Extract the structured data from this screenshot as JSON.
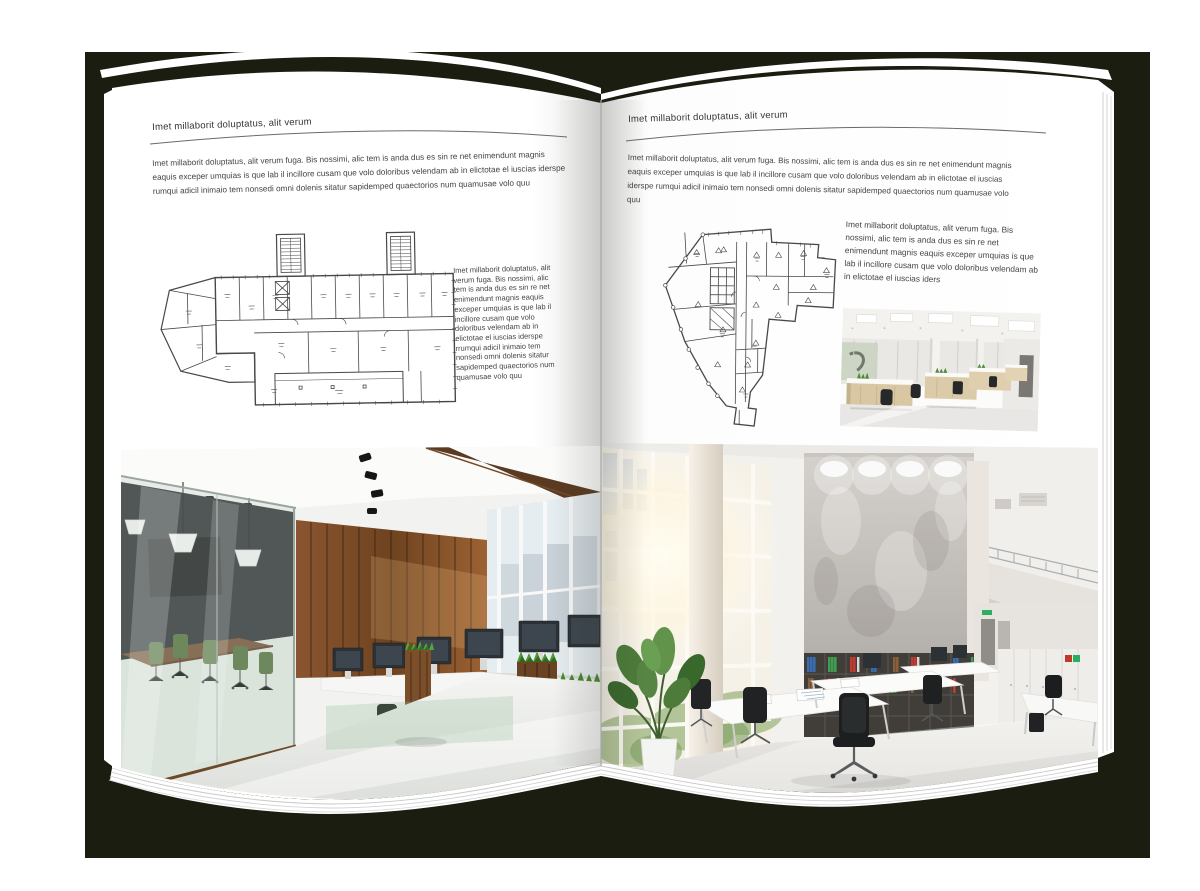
{
  "colors": {
    "backdrop": "#1b1d10",
    "page": "#ffffff",
    "body_text": "#444444",
    "rule": "#6a6a6a",
    "plan_ink": "#47484a",
    "wood": "#7a4e2a",
    "grass": "#4f9636",
    "binder_blue": "#3a6db0",
    "binder_green": "#3f9e4f",
    "binder_red": "#c23b30"
  },
  "left_page": {
    "header": "Imet millaborit doluptatus, alit verum",
    "intro": "Imet millaborit doluptatus, alit verum fuga. Bis nossimi, alic tem is anda dus es sin re net enimendunt magnis eaquis exceper umquias is que lab il incillore cusam que volo doloribus velendam ab in elictotae el iuscias iderspe rumqui adicil inimaio tem nonsedi omni dolenis sitatur sapidemped quaectorios num quamusae volo quu",
    "caption": "Imet millaborit doluptatus, alit verum fuga. Bis nossimi, alic tem is anda dus es sin re net enimendunt magnis eaquis exceper umquias is que lab il incillore cusam que volo doloribus velendam ab in elictotae el iuscias iderspe rrumqui adicil inimaio tem nonsedi omni dolenis sitatur sapidemped quaectorios num quamusae volo quu"
  },
  "right_page": {
    "header": "Imet millaborit doluptatus, alit verum",
    "intro": "Imet millaborit doluptatus, alit verum fuga. Bis nossimi, alic tem is anda dus es sin re net enimendunt magnis eaquis exceper umquias is que lab il incillore cusam que volo doloribus velendam ab in elictotae el iuscias iderspe rumqui adicil inimaio tem nonsedi omni dolenis sitatur sapidemped quaectorios num quamusae volo quu",
    "caption": "Imet millaborit doluptatus, alit verum fuga. Bis nossimi, alic tem is anda dus es sin re net enimendunt magnis eaquis exceper umquias is que lab il incillore cusam que volo doloribus velendam ab in elictotae el iuscias iders"
  }
}
